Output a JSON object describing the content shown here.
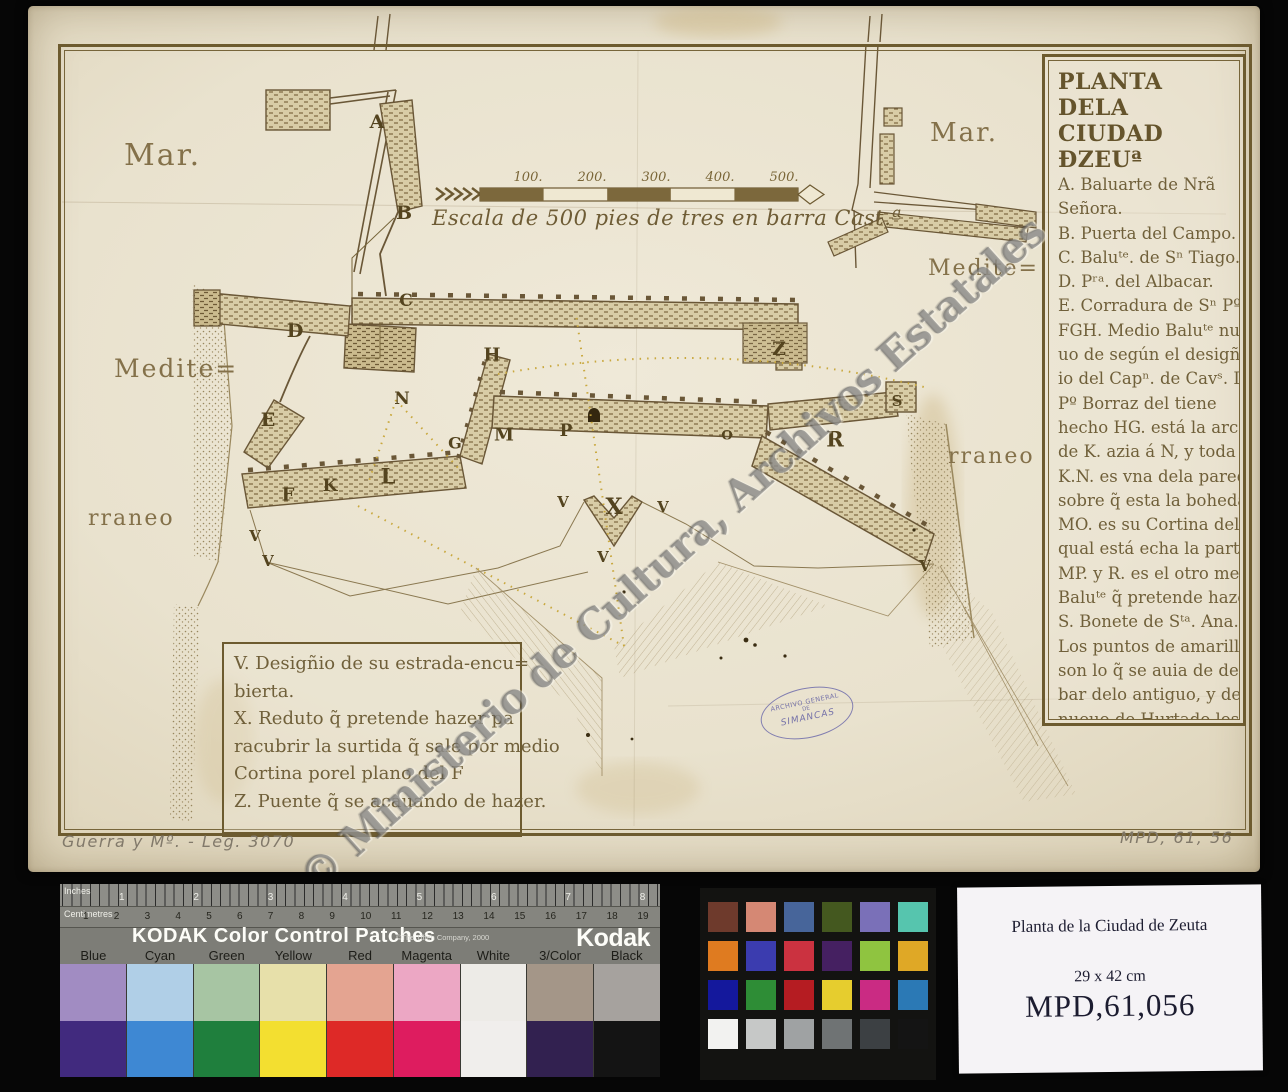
{
  "archive": {
    "watermark": "© Ministerio de Cultura, Archivos Estatales",
    "stamp": {
      "line1": "ARCHIVO GENERAL",
      "line2": "DE",
      "line3": "SIMANCAS"
    },
    "pencil_left": "Guerra y Mº. - Leg. 3070",
    "pencil_right": "MPD, 61, 56"
  },
  "map": {
    "legend": {
      "title1": "PLANTA DELA",
      "title2": "CIUDAD ĐZEUª",
      "lines": [
        "A. Baluarte de Nrã",
        "Señora.",
        "B. Puerta del Campo.",
        "C. Baluᵗᵉ. de Sⁿ Tiago.",
        "D. Pʳᵃ. del Albacar.",
        "E. Corradura de Sⁿ Pº",
        "FGH. Medio Baluᵗᵉ nue",
        "uo de según el desigñ",
        "io del Capⁿ. de Cavˢ. D.",
        "Pº Borraz del tiene",
        "hecho HG. está la arca",
        "de K. azia á N, y toda la",
        "K.N. es vna dela paredes",
        "sobre q̃ esta la boheda",
        "MO. es su Cortina dela",
        "qual está echa la parte",
        "MP. y R. es el otro medio",
        "Baluᵗᵉ q̃ pretende hazer.",
        "S. Bonete de Sᵗᵃ. Ana.",
        "Los puntos de amarillo",
        "son lo q̃ se auia de derri=",
        "bar delo antiguo, y de lo",
        "nueuo de Hurtado los",
        "de colorado."
      ]
    },
    "notes": {
      "lines": [
        "V. Desigñio de su estrada-encu=",
        "bierta.",
        "X. Reduto q̃ pretende hazer pa",
        "racubrir la surtida q̃ sale por medio",
        "Cortina porel plano del F",
        "Z. Puente q̃ se acauando de hazer."
      ]
    },
    "scale": {
      "caption": "Escala de 500 pies de tres en barra Cast.ª",
      "ticks": [
        {
          "label": "100.",
          "x": 500
        },
        {
          "label": "200.",
          "x": 564
        },
        {
          "label": "300.",
          "x": 628
        },
        {
          "label": "400.",
          "x": 692
        },
        {
          "label": "500.",
          "x": 756
        }
      ]
    },
    "sea_labels": [
      {
        "text": "Mar.",
        "x": 96,
        "y": 132,
        "size": 30
      },
      {
        "text": "Mar.",
        "x": 902,
        "y": 112,
        "size": 26
      },
      {
        "text": "Medite=",
        "x": 86,
        "y": 348,
        "size": 25
      },
      {
        "text": "Medite=",
        "x": 900,
        "y": 250,
        "size": 22
      },
      {
        "text": "rraneo",
        "x": 60,
        "y": 500,
        "size": 22
      },
      {
        "text": "rraneo",
        "x": 920,
        "y": 438,
        "size": 22
      }
    ],
    "letters": [
      {
        "t": "A",
        "x": 349,
        "y": 116,
        "s": 19
      },
      {
        "t": "B",
        "x": 376,
        "y": 207,
        "s": 19
      },
      {
        "t": "C",
        "x": 378,
        "y": 295,
        "s": 17
      },
      {
        "t": "D",
        "x": 267,
        "y": 325,
        "s": 19
      },
      {
        "t": "E",
        "x": 240,
        "y": 414,
        "s": 19
      },
      {
        "t": "F",
        "x": 260,
        "y": 489,
        "s": 18
      },
      {
        "t": "K",
        "x": 302,
        "y": 480,
        "s": 17
      },
      {
        "t": "L",
        "x": 360,
        "y": 470,
        "s": 21
      },
      {
        "t": "N",
        "x": 374,
        "y": 393,
        "s": 17
      },
      {
        "t": "G",
        "x": 427,
        "y": 437,
        "s": 16
      },
      {
        "t": "H",
        "x": 464,
        "y": 349,
        "s": 18
      },
      {
        "t": "M",
        "x": 476,
        "y": 429,
        "s": 18
      },
      {
        "t": "P",
        "x": 538,
        "y": 425,
        "s": 17
      },
      {
        "t": "O",
        "x": 699,
        "y": 430,
        "s": 13
      },
      {
        "t": "R",
        "x": 807,
        "y": 433,
        "s": 21
      },
      {
        "t": "S",
        "x": 869,
        "y": 395,
        "s": 15
      },
      {
        "t": "Z",
        "x": 751,
        "y": 343,
        "s": 19
      },
      {
        "t": "X",
        "x": 586,
        "y": 501,
        "s": 22
      },
      {
        "t": "V",
        "x": 227,
        "y": 530,
        "s": 15
      },
      {
        "t": "V",
        "x": 240,
        "y": 555,
        "s": 15
      },
      {
        "t": "V",
        "x": 535,
        "y": 496,
        "s": 15
      },
      {
        "t": "V",
        "x": 635,
        "y": 501,
        "s": 15
      },
      {
        "t": "V",
        "x": 575,
        "y": 551,
        "s": 15
      },
      {
        "t": "V",
        "x": 897,
        "y": 560,
        "s": 15
      }
    ]
  },
  "kodak": {
    "ruler_top_label": "Inches",
    "ruler_top_numbers": [
      "1",
      "2",
      "3",
      "4",
      "5",
      "6",
      "7",
      "8"
    ],
    "ruler_bottom_label": "Centimetres",
    "ruler_bottom_numbers": [
      "1",
      "2",
      "3",
      "4",
      "5",
      "6",
      "7",
      "8",
      "9",
      "10",
      "11",
      "12",
      "13",
      "14",
      "15",
      "16",
      "17",
      "18",
      "19"
    ],
    "title": "KODAK Color Control Patches",
    "copyright": "©The Tiffen Company, 2000",
    "brand": "Kodak",
    "brand_sub": "LICENSED PRODUCT",
    "columns": [
      {
        "label": "Blue",
        "tint": "#a18cc2",
        "full": "#412a7e"
      },
      {
        "label": "Cyan",
        "tint": "#b0cfe7",
        "full": "#3e88d3"
      },
      {
        "label": "Green",
        "tint": "#a7c5a3",
        "full": "#1f7f3d"
      },
      {
        "label": "Yellow",
        "tint": "#e7e0aa",
        "full": "#f3df30"
      },
      {
        "label": "Red",
        "tint": "#e4a491",
        "full": "#de2927"
      },
      {
        "label": "Magenta",
        "tint": "#eca7c4",
        "full": "#de1c5f"
      },
      {
        "label": "White",
        "tint": "#edebe7",
        "full": "#f0eeec"
      },
      {
        "label": "3/Color",
        "tint": "#a49688",
        "full": "#322150"
      },
      {
        "label": "Black",
        "tint": "#a6a29e",
        "full": "#141414"
      }
    ]
  },
  "colorchecker": {
    "rows": [
      [
        "#6e3a2c",
        "#d58874",
        "#47659a",
        "#44581f",
        "#7a70b8",
        "#56c5ae"
      ],
      [
        "#df7b20",
        "#3b3caf",
        "#cb3240",
        "#452061",
        "#8fc440",
        "#dfa826"
      ],
      [
        "#14189c",
        "#2e8d36",
        "#b51c22",
        "#e6cd2e",
        "#ca2b83",
        "#2b79b5"
      ],
      [
        "#f2f2f0",
        "#c6c8c7",
        "#9fa2a3",
        "#6f7374",
        "#3c4043",
        "#141414"
      ]
    ]
  },
  "card": {
    "title": "Planta de la Ciudad de Zeuta",
    "dimensions": "29 x 42 cm",
    "reference": "MPD,61,056"
  }
}
